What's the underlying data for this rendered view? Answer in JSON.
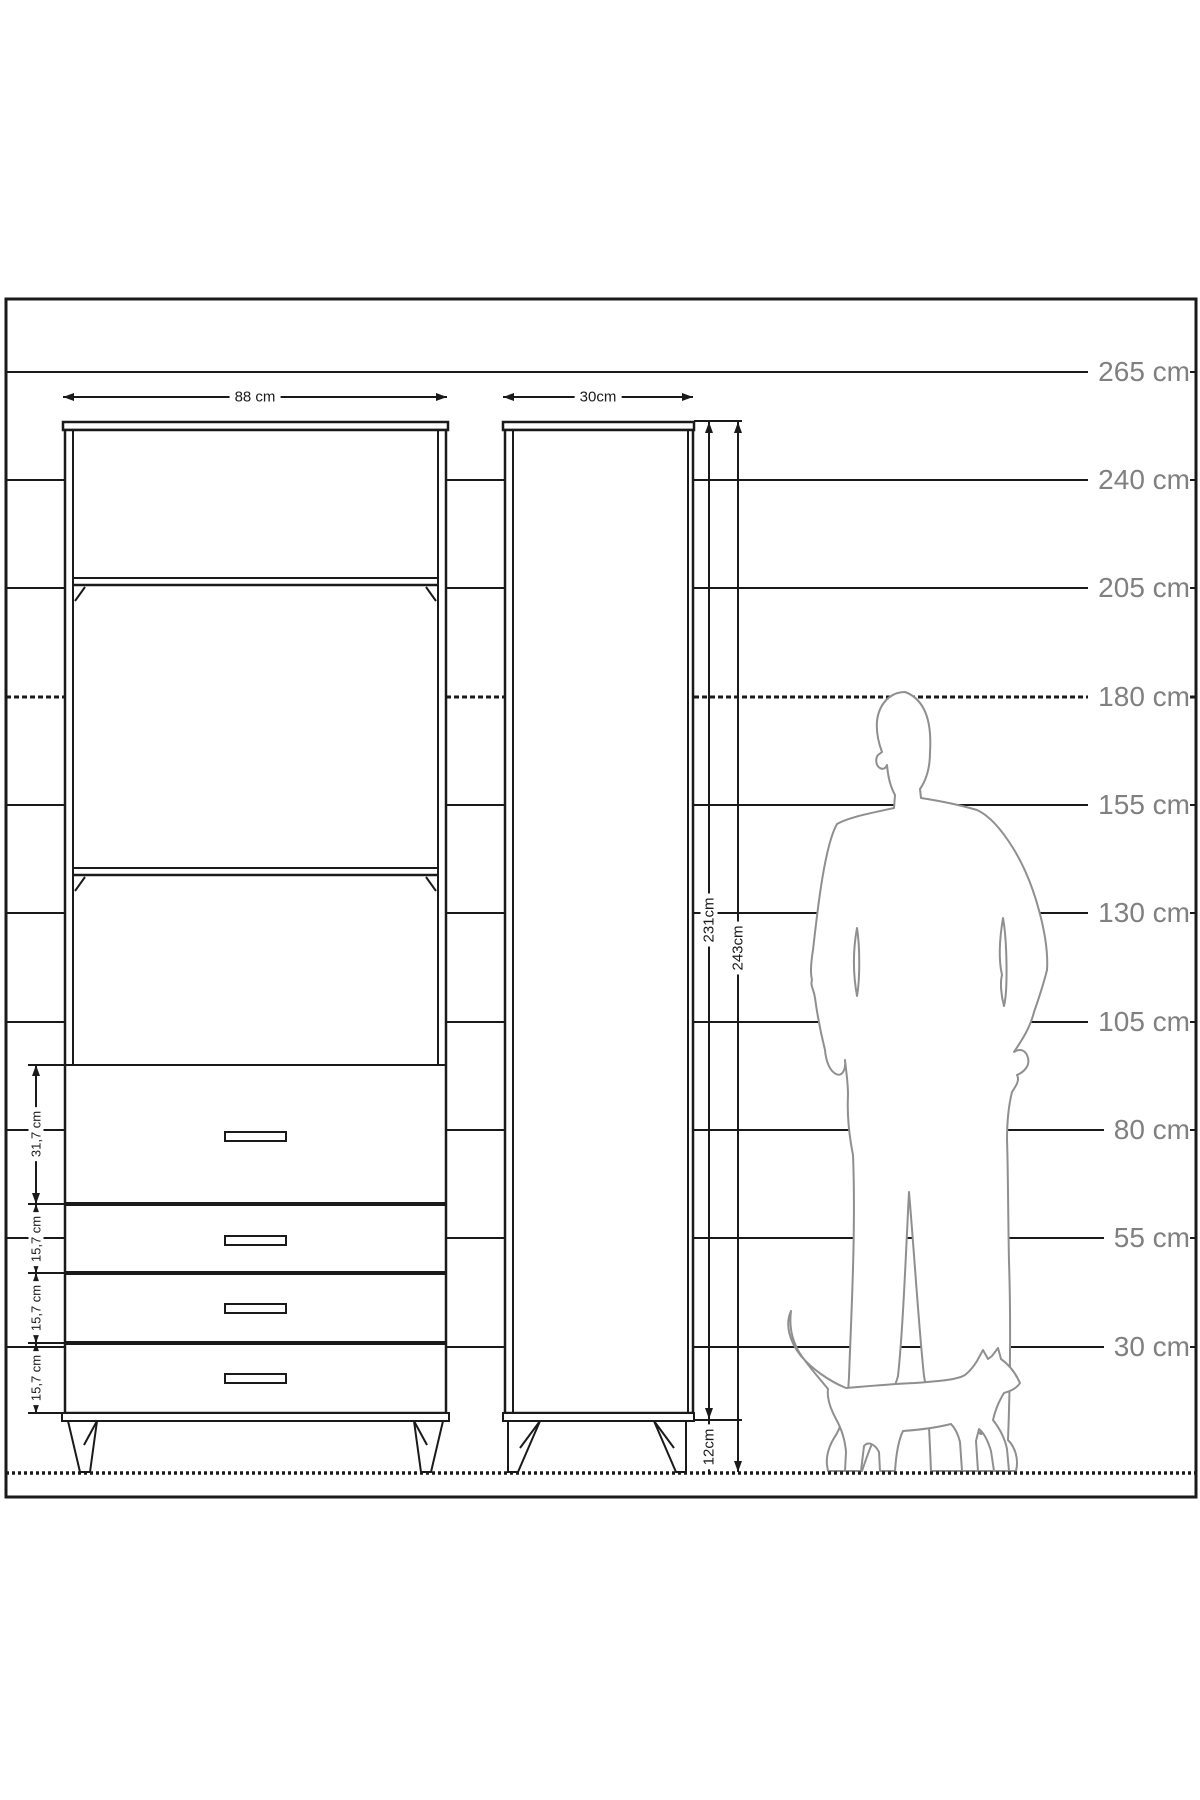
{
  "colors": {
    "background": "#ffffff",
    "line": "#1a1a1a",
    "figure_outline": "#8f8f8f",
    "scale_text": "#808080",
    "dim_text": "#1a1a1a"
  },
  "scale_ruler": {
    "unit": "cm",
    "values": [
      265,
      240,
      205,
      180,
      155,
      130,
      105,
      80,
      55,
      30
    ],
    "labels": [
      "265 cm",
      "240 cm",
      "205 cm",
      "180 cm",
      "155 cm",
      "130 cm",
      "105 cm",
      "80 cm",
      "55 cm",
      "30 cm"
    ]
  },
  "front_view": {
    "width_label": "88 cm",
    "drawer_count": 4,
    "shelf_count": 3,
    "drawer_height_labels": [
      "31,7 cm",
      "15,7 cm",
      "15,7 cm",
      "15,7 cm"
    ]
  },
  "side_view": {
    "depth_label": "30cm",
    "body_height_label": "231cm",
    "total_height_label": "243cm",
    "leg_height_label": "12cm"
  },
  "figures": {
    "man_icon": "man-silhouette",
    "cat_icon": "cat-silhouette"
  }
}
